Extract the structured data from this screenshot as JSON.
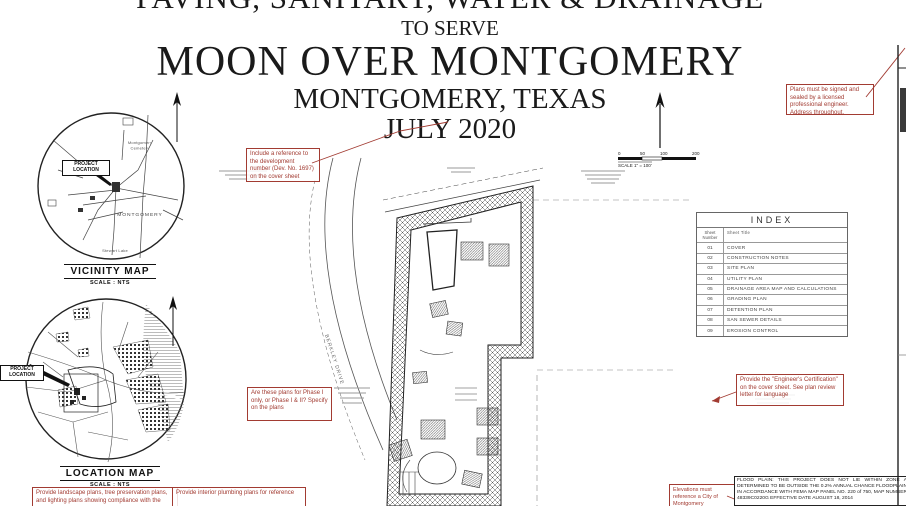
{
  "title_block": {
    "line1": "PAVING, SANITARY, WATER & DRAINAGE",
    "line2": "TO SERVE",
    "project": "MOON OVER MONTGOMERY",
    "city": "MONTGOMERY, TEXAS",
    "date": "JULY 2020"
  },
  "vicinity_map": {
    "title": "VICINITY MAP",
    "scale": "SCALE : NTS",
    "project_location": "PROJECT LOCATION",
    "town": "MONTGOMERY",
    "cemetery": "Montgomery Cemetery",
    "lake": "Stewart Lake"
  },
  "location_map": {
    "title": "LOCATION MAP",
    "scale": "SCALE : NTS",
    "project_location": "PROJECT LOCATION"
  },
  "site_plan": {
    "street_label": "BERKLEY DRIVE",
    "scale_bar": {
      "ticks": [
        "0",
        "50",
        "100",
        "200"
      ],
      "caption": "SCALE 1\" = 100'"
    }
  },
  "index_table": {
    "title": "INDEX",
    "col_number": "Sheet Number",
    "col_title": "Sheet Title",
    "rows": [
      {
        "num": "01",
        "title": "COVER"
      },
      {
        "num": "02",
        "title": "CONSTRUCTION NOTES"
      },
      {
        "num": "03",
        "title": "SITE PLAN"
      },
      {
        "num": "04",
        "title": "UTILITY PLAN"
      },
      {
        "num": "05",
        "title": "DRAINAGE AREA MAP AND CALCULATIONS"
      },
      {
        "num": "06",
        "title": "GRADING PLAN"
      },
      {
        "num": "07",
        "title": "DETENTION PLAN"
      },
      {
        "num": "08",
        "title": "SAN SEWER DETAILS"
      },
      {
        "num": "09",
        "title": "EROSION CONTROL"
      }
    ]
  },
  "annotations": {
    "dev_number": "Include a reference to the development number (Dev. No. 1697) on the cover sheet",
    "signed_sealed": "Plans must be signed and sealed by a licensed professional engineer. Address throughout.",
    "phase": "Are these plans for Phase I only, or Phase I & II? Specify on the plans",
    "certification": "Provide the \"Engineer's Certification\" on the cover sheet. See plan review letter for language",
    "landscape": "Provide landscape plans, tree preservation plans, and lighting plans showing compliance with the",
    "plumbing": "Provide interior plumbing plans for reference",
    "elevations": "Elevations must reference a City of Montgomery"
  },
  "flood_note": "FLOOD PLAIN: THIS PROJECT DOES NOT LIE WITHIN ZONE A DETERMINED TO BE OUTSIDE THE 0.2% ANNUAL CHANCE FLOODPLAIN IN ACCORDANCE WITH FEMA MAP PANEL NO. 220 of 750, MAP NUMBER 48339C0220G EFFECTIVE DATE AUGUST 18, 2014",
  "colors": {
    "annotation_red": "#a23b32",
    "line_black": "#1a1a1a"
  }
}
